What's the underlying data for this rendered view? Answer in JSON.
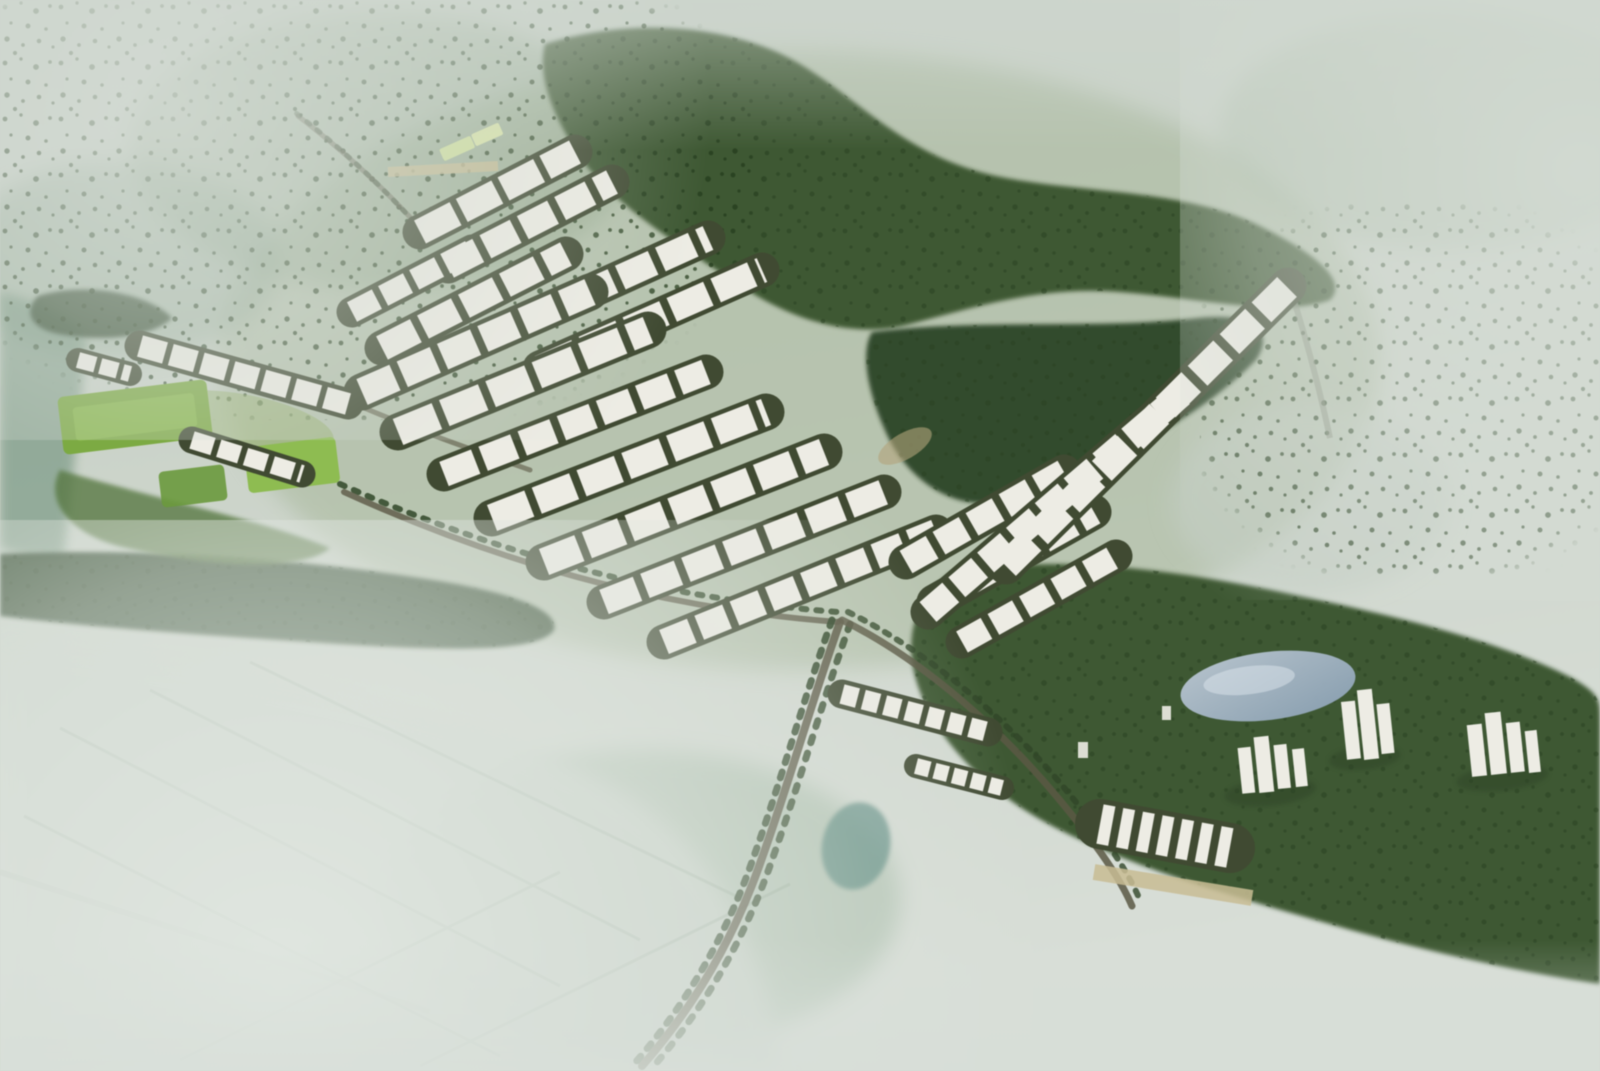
{
  "image": {
    "kind": "aerial-masterplan-rendering",
    "subject": "Bird's-eye watercolor-style rendering of a planned township: rows of white residential blocks carved into dense green forest, sports fields to the west, a blue lake with scattered tower clusters in the southeast woodland, tree-lined roads winding south, and pale misty farmland in the foreground",
    "alt_text": "Aerial rendering of a forested township master plan with white building clusters, sports fields, a lake and winding tree-lined roads under pale mist"
  },
  "palette": {
    "haze_top": "#c7d0c7",
    "haze_mid": "#ccd4ca",
    "haze_low": "#d8ded7",
    "terrain_green": "#a3b493",
    "forest_green": "#3c5831",
    "forest_dark": "#2c4526",
    "canopy_dot": "#27401f",
    "field_green": "#7bab3e",
    "field_green_light": "#8cbd4c",
    "court_green": "#699a38",
    "building_white": "#edece4",
    "row_shadow": "#404a31",
    "road_brown": "#5b5843",
    "tree_line": "#2f4627",
    "field_line": "#7d947f",
    "lake_light": "#bcc9d6",
    "lake_deep": "#8aa1b6",
    "pond_teal": "#41796f",
    "sand_tan": "#c9bd92",
    "roof_lime": "#cfe09a",
    "fog_white": "#dde4dd"
  }
}
